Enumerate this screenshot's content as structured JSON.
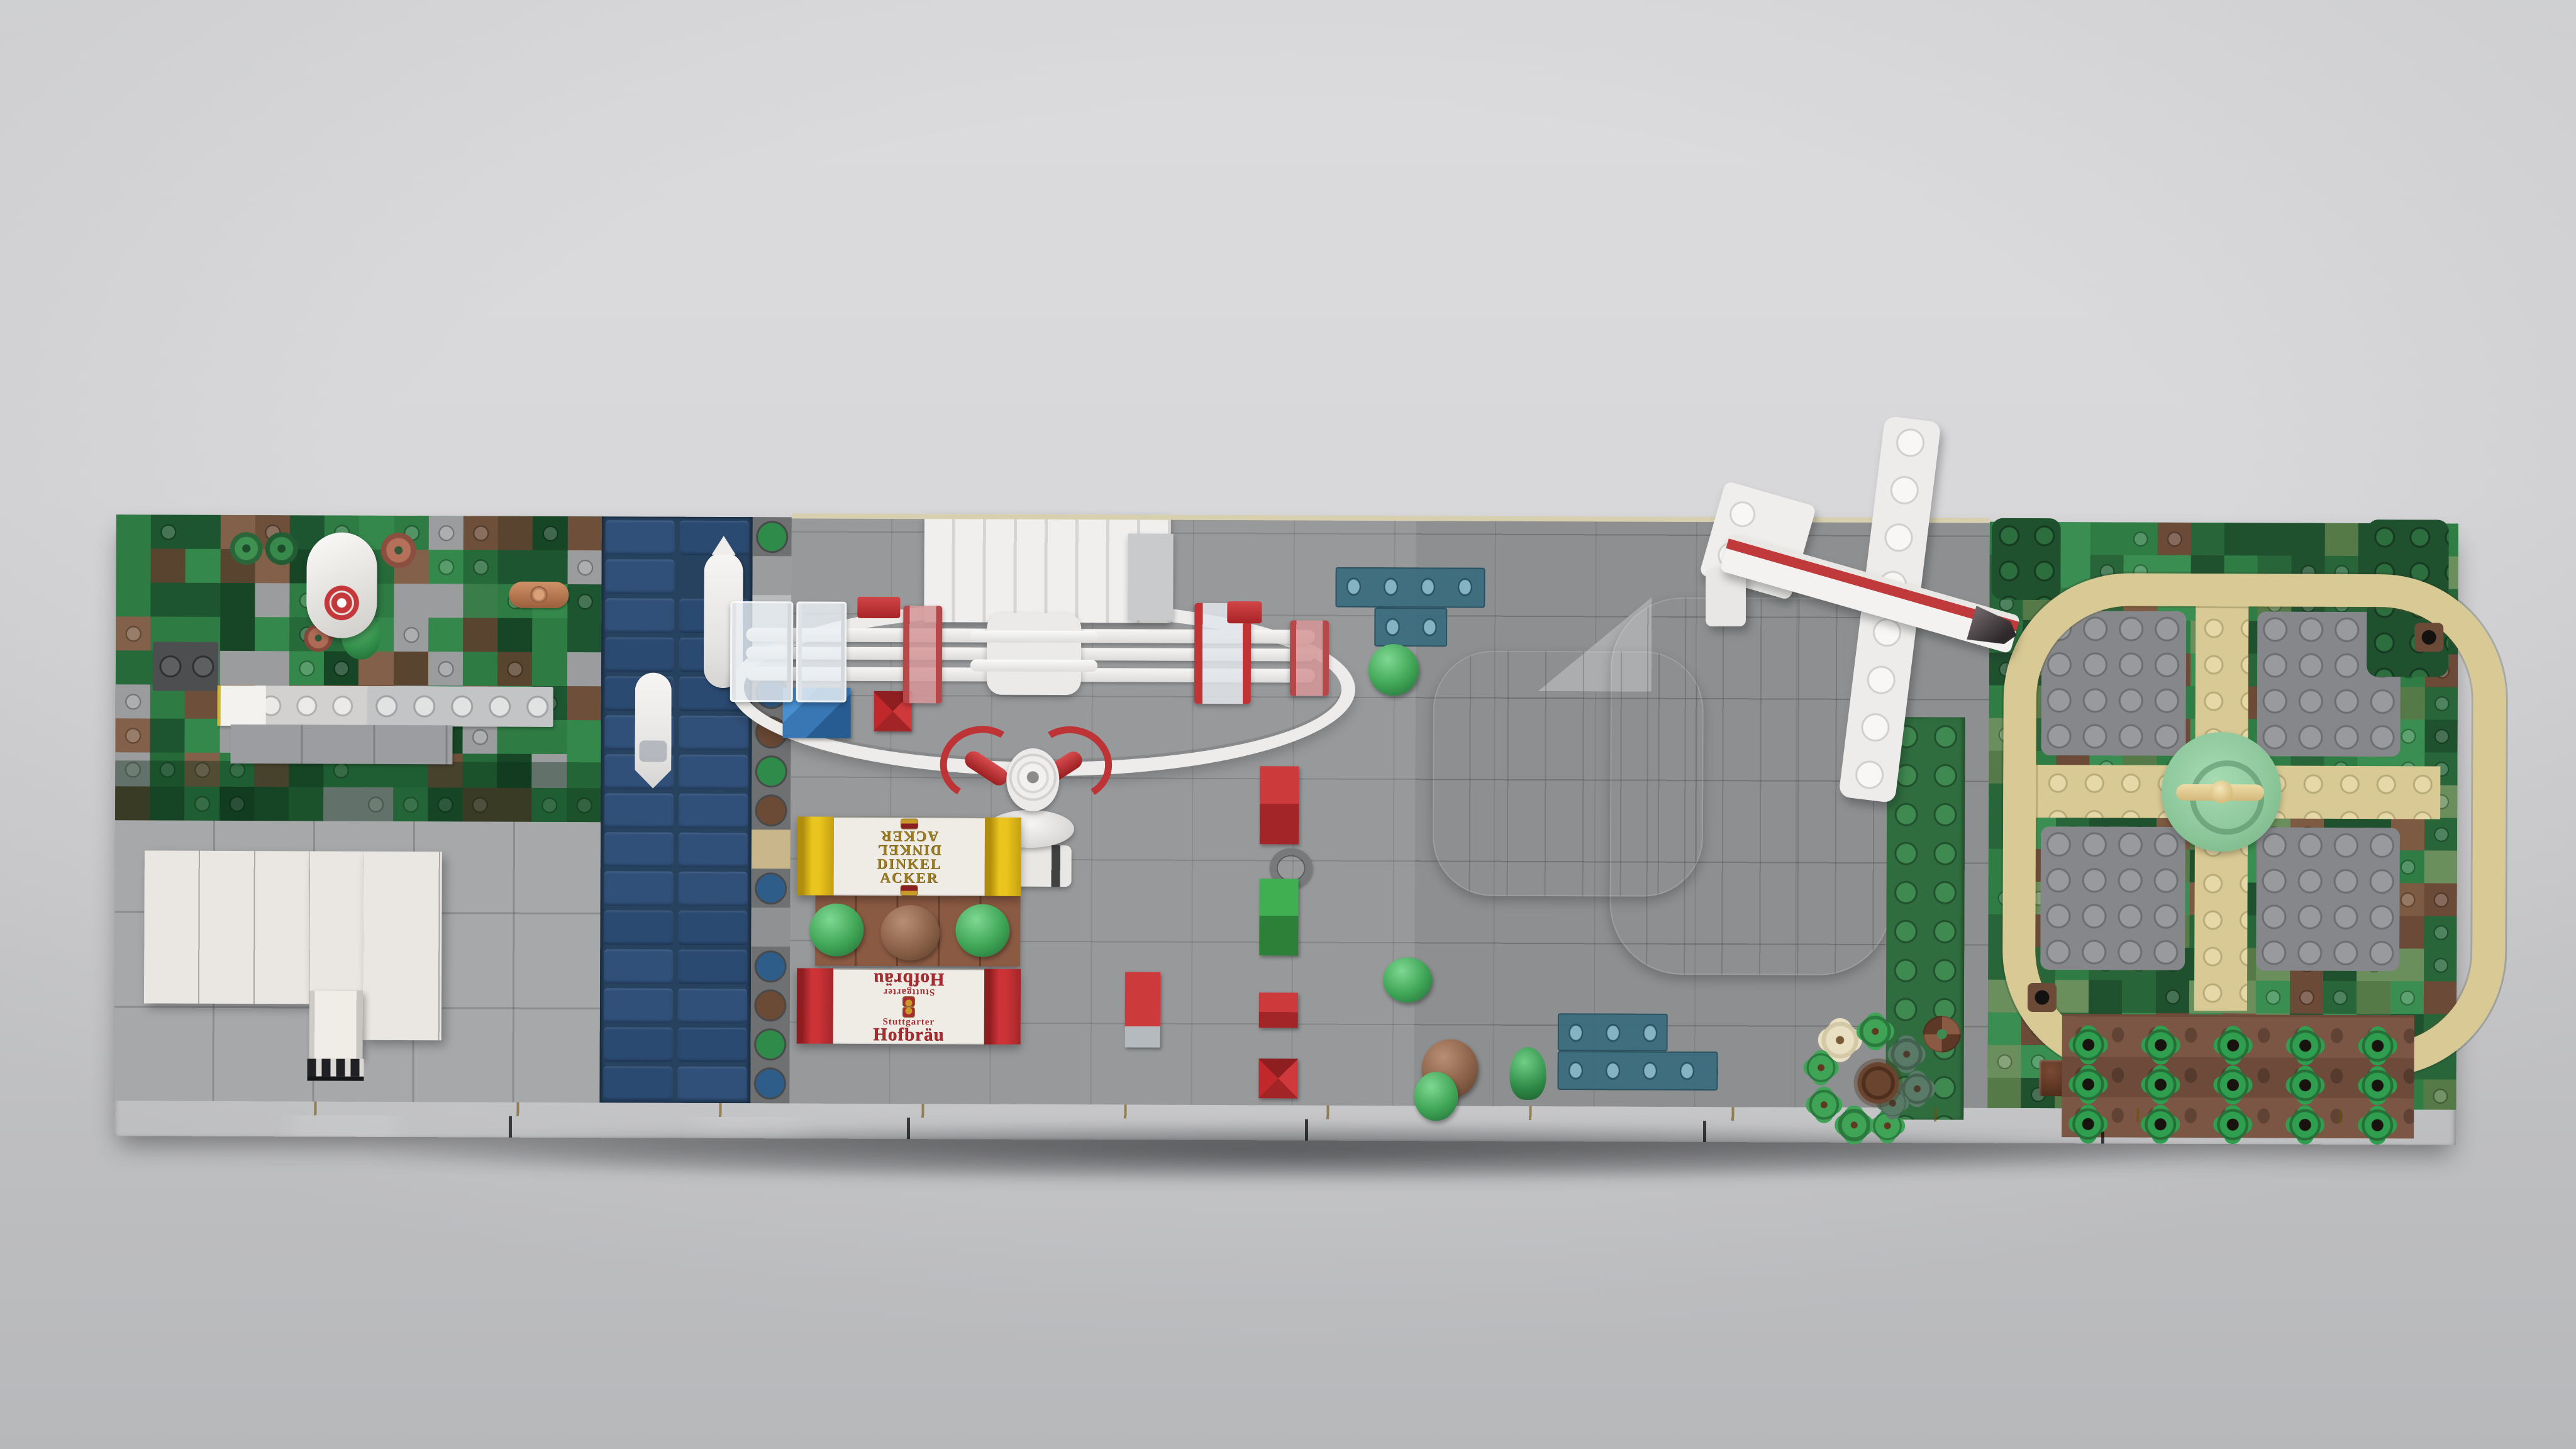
{
  "scene": {
    "labels": {
      "tent_yellow_line1": "DINKEL",
      "tent_yellow_line2": "ACKER",
      "tent_red_line1": "Stuttgarter",
      "tent_red_line2": "Hofbräu"
    },
    "colors": {
      "background_gray": "#d6d6d8",
      "baseplate_gray": "#97999b",
      "plaza_light": "#a6a8aa",
      "road_black": "#1a1b1d",
      "curb_yellow": "#d9ae12",
      "river_blue": "#27425f",
      "hall_gray": "#a8aaac",
      "tent_yellow": "#eac51d",
      "tent_red": "#cb3337",
      "tent_canvas_white": "#efece6",
      "tent_gold_text": "#9a7b20",
      "tent_red_text": "#a62c31",
      "table_brown": "#8b5a43",
      "park_path_tan": "#d9c994",
      "park_plate_gray": "#85878a",
      "park_center_green": "#8cc79a",
      "plant_green": "#2f9e4f",
      "soil_brown": "#7c5645",
      "plane_white": "#f1f0ee",
      "plane_stripe_red": "#c0393b",
      "tower_ring_red": "#c4373a",
      "teal_trans": "#386c7e",
      "crate_red": "#cd3a3c",
      "crate_green": "#3faf52",
      "crate_blue": "#3877b4"
    },
    "palettes": {
      "forest": [
        "#2e7b44",
        "#276a3a",
        "#1d5530",
        "#35884c",
        "#174627",
        "#3a7d4b",
        "#6e4f3a",
        "#82604a",
        "#59442f",
        "#2e7b44",
        "#1d5530",
        "#9a9c9e",
        "#276a3a",
        "#35884c"
      ],
      "park": [
        "#2f7d45",
        "#3b8e52",
        "#28663a",
        "#557a47",
        "#6b8f5c",
        "#1f512f",
        "#6b4a38",
        "#7d5a42",
        "#2f7d45",
        "#3b8e52",
        "#28663a",
        "#1f512f"
      ]
    },
    "shore_tiles": [
      "#2e8b4a",
      "#9a9c9e",
      "#b9bbbd",
      "#cfd6dc",
      "#2f5d8a",
      "#6b4a36",
      "#2e8b4a",
      "#6b4a36",
      "#c9b68a",
      "#2f5d8a",
      "#8f9193",
      "#2f5d8a",
      "#6b4a36",
      "#2e8b4a",
      "#2f5d8a"
    ],
    "grids": {
      "forest": {
        "cols": 14,
        "rows": 9,
        "cellW": 55.2,
        "cellH": 54,
        "stud": 0.38,
        "seed": 7
      },
      "park": {
        "cols": 14,
        "rows": 18,
        "cellW": 53.3,
        "cellH": 52,
        "stud": 0.42,
        "seed": 11
      },
      "river_rows": 15,
      "garden": {
        "cols": 5,
        "rows": 3,
        "startX": 3114,
        "startY": 806,
        "stepX": 115,
        "stepY": 63
      }
    }
  }
}
